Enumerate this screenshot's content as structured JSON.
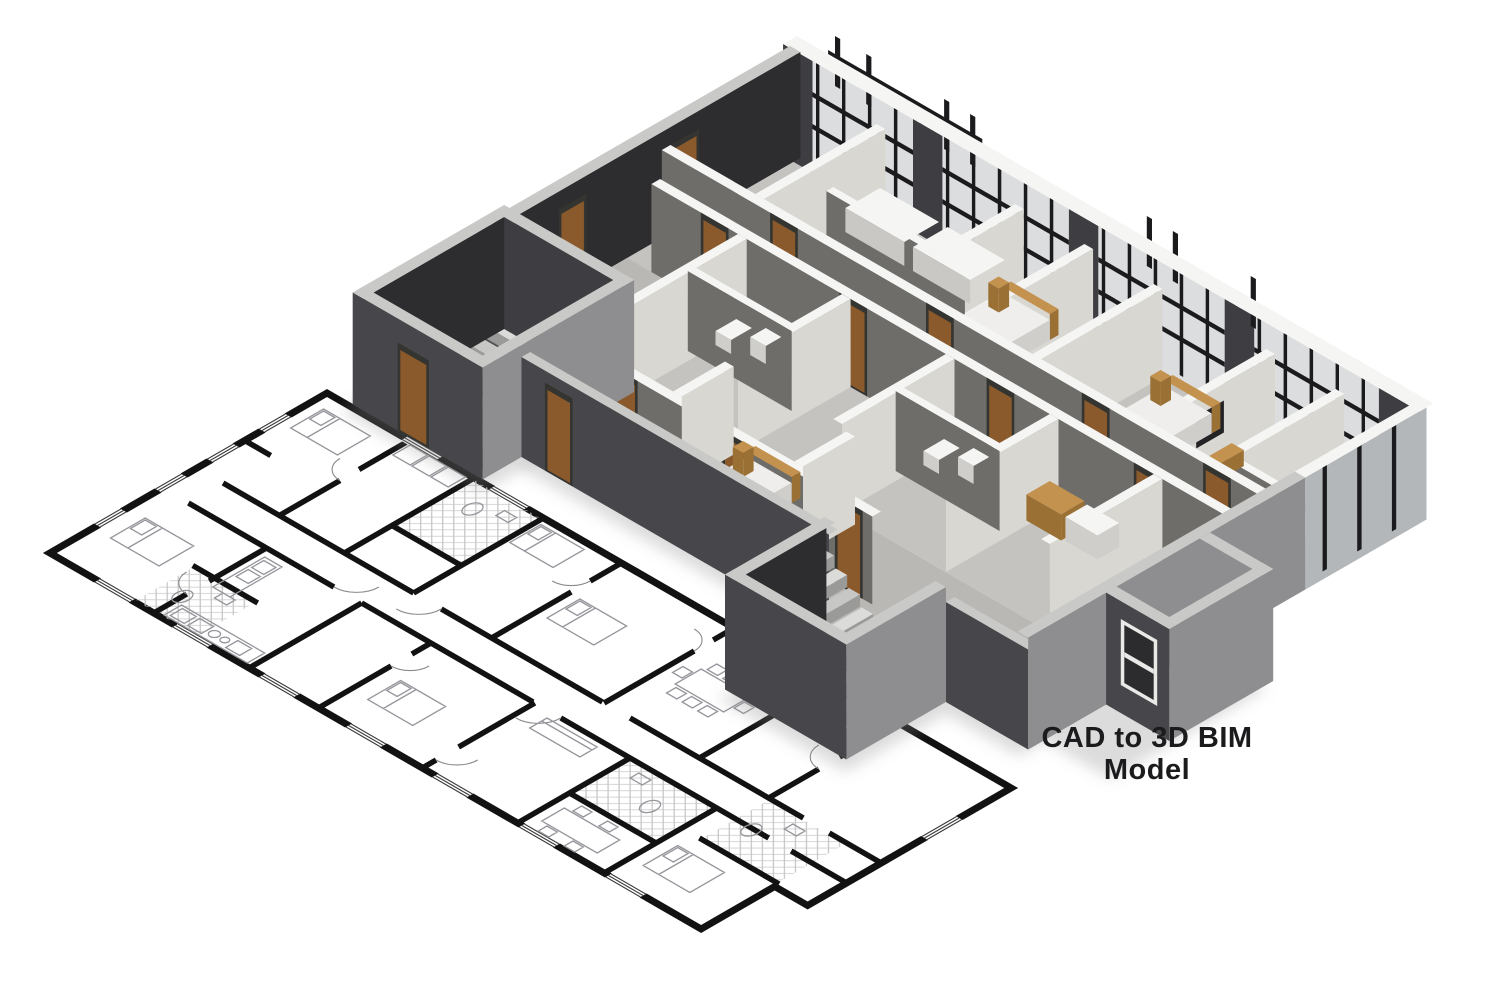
{
  "caption": {
    "line1": "CAD to 3D BIM",
    "line2": "Model"
  },
  "colors": {
    "background": "#ffffff",
    "caption": "#1b1b1d",
    "wallDark": "#3e3e42",
    "wallDarker": "#2d2d30",
    "wallOuterDark": "#47474b",
    "wallMid": "#8e8e90",
    "faceEast": "#d8d7d2",
    "faceSouth": "#6e6d69",
    "shelfShade": "#c9c8c4",
    "topWhite": "#f5f5f3",
    "topLight": "#c9c9c7",
    "floor": "#c4c3c0",
    "corridor": "#cfcecb",
    "floorDim": "#b9b8b5",
    "towerFloor": "#515155",
    "glass": "#dcddde",
    "glassDim": "#b4b7b9",
    "bayGlass": "#2c2c2f",
    "frameLight": "#e9e9e7",
    "mullion": "#1b1b1d",
    "door": "#8a5a2c",
    "doorFrame": "#343430",
    "stepA": "#dbdbd9",
    "stepB": "#c7c7c5",
    "riser": "#9a9a98",
    "bedWhite": "#efeeec",
    "bedShade": "#cfcecb",
    "tan": "#c3924f",
    "tanDark": "#9a7034",
    "tv": "#232326",
    "shadow": "#8c8c8c",
    "planWall": "#121212",
    "planThin": "#97969c",
    "planHatch": "#c4c4c4"
  }
}
